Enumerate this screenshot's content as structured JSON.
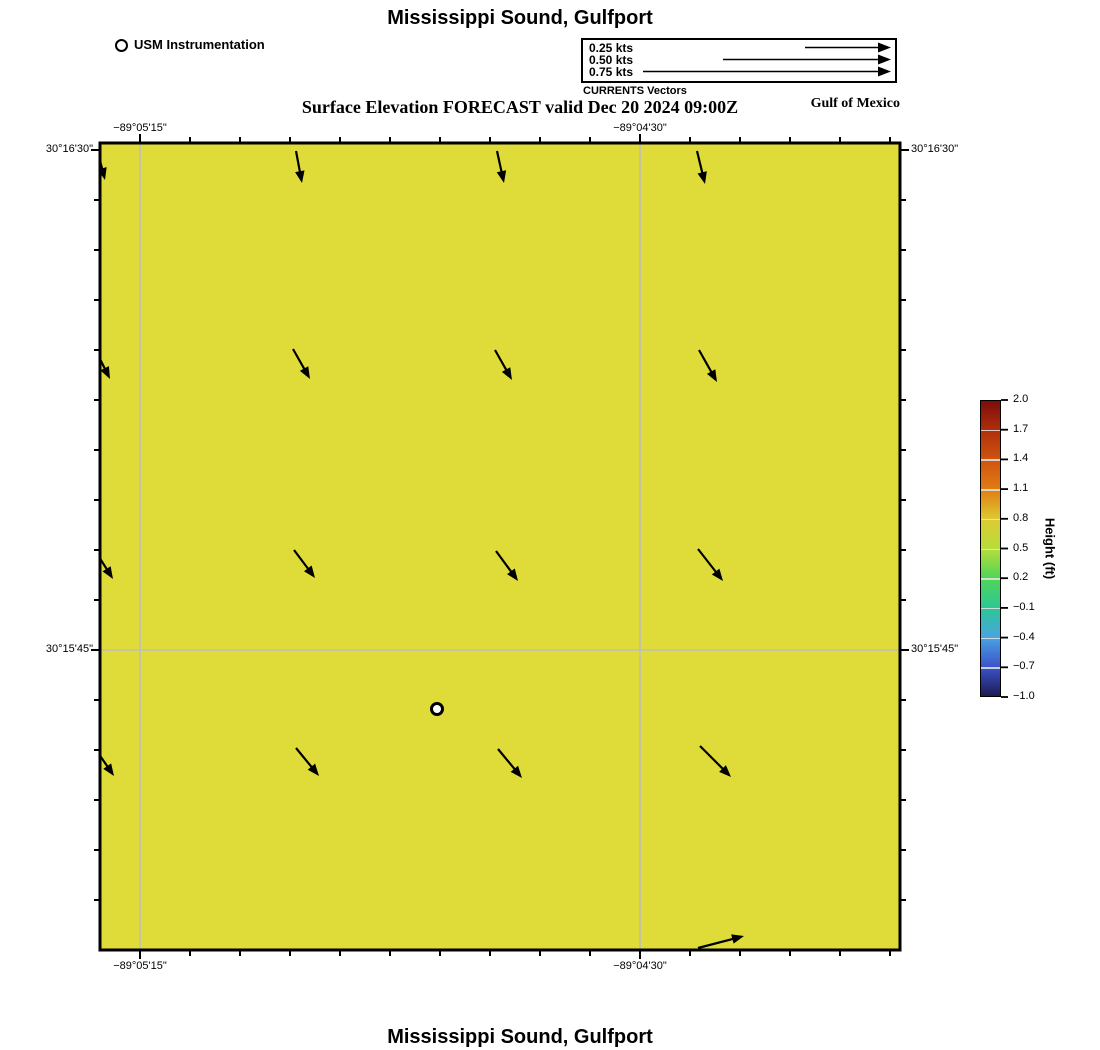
{
  "header": {
    "title": "Mississippi Sound, Gulfport",
    "subtitle": "Surface Elevation FORECAST valid Dec 20 2024 09:00Z",
    "usm_legend": "USM Instrumentation",
    "currents_caption": "CURRENTS Vectors",
    "region_label": "Gulf of Mexico",
    "speed_scale": [
      {
        "label": "0.25 kts",
        "start_x": 805
      },
      {
        "label": "0.50 kts",
        "start_x": 723
      },
      {
        "label": "0.75 kts",
        "start_x": 643
      }
    ],
    "speed_tip_x": 891
  },
  "map": {
    "background_color": "#dfdc3a",
    "grid_color": "#bdbdbd",
    "x_gridlines": [
      140,
      640
    ],
    "y_gridlines": [
      650
    ],
    "x_ticks": [
      {
        "label": "−89°05'15\"",
        "x": 140
      },
      {
        "label": "−89°04'30\"",
        "x": 640
      }
    ],
    "y_ticks": [
      {
        "label": "30°16'30\"",
        "y": 150
      },
      {
        "label": "30°15'45\"",
        "y": 650
      }
    ],
    "station": {
      "x": 437,
      "y": 709,
      "name": "USM Instrumentation"
    },
    "current_vectors": [
      {
        "x1": 97,
        "y1": 149,
        "x2": 105,
        "y2": 180
      },
      {
        "x1": 296,
        "y1": 151,
        "x2": 302,
        "y2": 183
      },
      {
        "x1": 497,
        "y1": 151,
        "x2": 504,
        "y2": 183
      },
      {
        "x1": 697,
        "y1": 151,
        "x2": 705,
        "y2": 184
      },
      {
        "x1": 95,
        "y1": 349,
        "x2": 110,
        "y2": 379
      },
      {
        "x1": 293,
        "y1": 349,
        "x2": 310,
        "y2": 379
      },
      {
        "x1": 495,
        "y1": 350,
        "x2": 512,
        "y2": 380
      },
      {
        "x1": 699,
        "y1": 350,
        "x2": 717,
        "y2": 382
      },
      {
        "x1": 94,
        "y1": 549,
        "x2": 113,
        "y2": 579
      },
      {
        "x1": 294,
        "y1": 550,
        "x2": 315,
        "y2": 578
      },
      {
        "x1": 496,
        "y1": 551,
        "x2": 518,
        "y2": 581
      },
      {
        "x1": 698,
        "y1": 549,
        "x2": 723,
        "y2": 581
      },
      {
        "x1": 94,
        "y1": 747,
        "x2": 114,
        "y2": 776
      },
      {
        "x1": 296,
        "y1": 748,
        "x2": 319,
        "y2": 776
      },
      {
        "x1": 498,
        "y1": 749,
        "x2": 522,
        "y2": 778
      },
      {
        "x1": 700,
        "y1": 746,
        "x2": 731,
        "y2": 777
      },
      {
        "x1": 698,
        "y1": 948,
        "x2": 744,
        "y2": 936
      }
    ]
  },
  "colorbar": {
    "label": "Height (ft)",
    "ticks": [
      "2.0",
      "1.7",
      "1.4",
      "1.1",
      "0.8",
      "0.5",
      "0.2",
      "−0.1",
      "−0.4",
      "−0.7",
      "−1.0"
    ],
    "gradient": [
      {
        "pos": 0,
        "color": "#7d0d0b"
      },
      {
        "pos": 10,
        "color": "#b02f0b"
      },
      {
        "pos": 20,
        "color": "#cf5410"
      },
      {
        "pos": 30,
        "color": "#e07d13"
      },
      {
        "pos": 40,
        "color": "#ddca32"
      },
      {
        "pos": 50,
        "color": "#b6dd3b"
      },
      {
        "pos": 60,
        "color": "#52d556"
      },
      {
        "pos": 70,
        "color": "#2dc795"
      },
      {
        "pos": 80,
        "color": "#49a4e0"
      },
      {
        "pos": 90,
        "color": "#3c55cc"
      },
      {
        "pos": 100,
        "color": "#1c1a52"
      }
    ]
  },
  "footer": {
    "title": "Mississippi Sound, Gulfport"
  }
}
